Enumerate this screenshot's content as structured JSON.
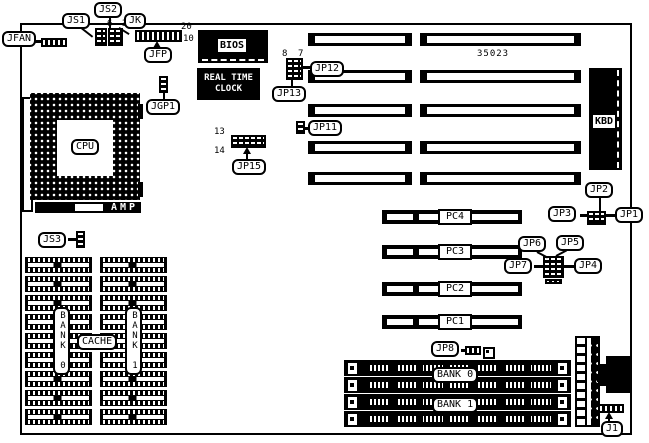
{
  "diagram": {
    "part_number": "35023",
    "chips": {
      "bios_label": "BIOS",
      "rtc_line1": "REAL TIME",
      "rtc_line2": "CLOCK",
      "cpu_label": "CPU",
      "socket_brand": "AMP",
      "kbd_label": "KBD"
    },
    "cache": {
      "label": "CACHE",
      "banks": [
        "BANK 0",
        "BANK 1"
      ],
      "chip_rows_per_column": 9
    },
    "memory": {
      "banks": [
        "BANK 0",
        "BANK 1"
      ],
      "simm_slot_count": 4
    },
    "expansion": {
      "isa_slot_rows": 5,
      "pci_slots": [
        "PC4",
        "PC3",
        "PC2",
        "PC1"
      ]
    },
    "jumpers": {
      "jfan": "JFAN",
      "js1": "JS1",
      "js2": "JS2",
      "jk": "JK",
      "jfp": "JFP",
      "jgp1": "JGP1",
      "js3": "JS3",
      "jp15": "JP15",
      "jp12": "JP12",
      "jp13": "JP13",
      "jp11": "JP11",
      "jp1": "JP1",
      "jp2": "JP2",
      "jp3": "JP3",
      "jp4": "JP4",
      "jp5": "JP5",
      "jp6": "JP6",
      "jp7": "JP7",
      "jp8": "JP8",
      "j1": "J1"
    },
    "pin_numbers": {
      "jfp_end": "20",
      "jfp_mid": "10",
      "js2_pins": "6 3",
      "jp12_pin8": "8",
      "jp12_pin7": "7",
      "jp15_pin13": "13",
      "jp15_pin14": "14"
    },
    "colors": {
      "ink": "#000000",
      "paper": "#ffffff"
    }
  }
}
